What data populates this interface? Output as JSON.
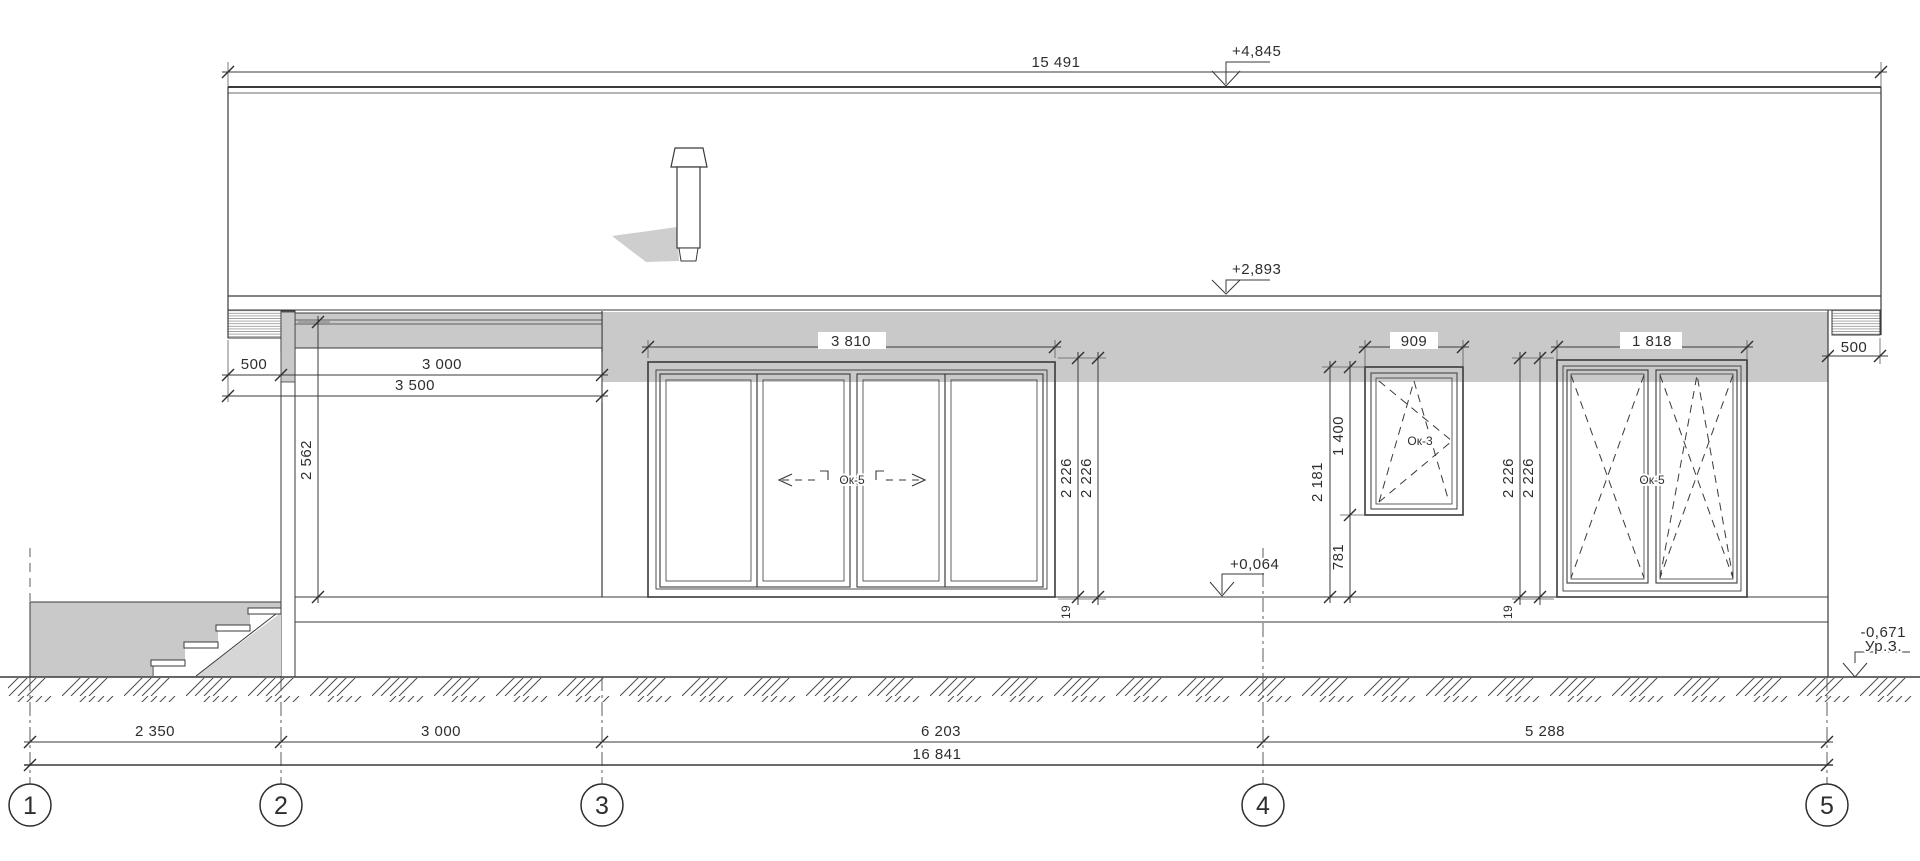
{
  "levels": {
    "roof": "+4,845",
    "eaves": "+2,893",
    "floor": "+0,064",
    "ground": "-0,671",
    "ground_label": "Ур.З."
  },
  "top": {
    "roof_span": "15 491"
  },
  "porch": {
    "overhang": "500",
    "width": "3 000",
    "overall": "3 500",
    "height": "2 562"
  },
  "w1": {
    "width": "3 810",
    "label": "Ок-5",
    "h1": "2 226",
    "h2": "2 226",
    "sill": "19"
  },
  "w2": {
    "width": "909",
    "label": "Ок-3",
    "height": "1 400",
    "head": "2 181",
    "sill": "781"
  },
  "w3": {
    "width": "1 818",
    "label": "Ок-5",
    "h1": "2 226",
    "h2": "2 226",
    "sill": "19"
  },
  "right": {
    "overhang": "500"
  },
  "bottom": {
    "d12": "2 350",
    "d23": "3 000",
    "d34": "6 203",
    "d45": "5 288",
    "total": "16 841"
  },
  "axes": {
    "a1": "1",
    "a2": "2",
    "a3": "3",
    "a4": "4",
    "a5": "5"
  },
  "colors": {
    "line": "#3a3a3a",
    "shadow": "#c9c9c9",
    "ground_hatch": "#4a4a4a"
  }
}
